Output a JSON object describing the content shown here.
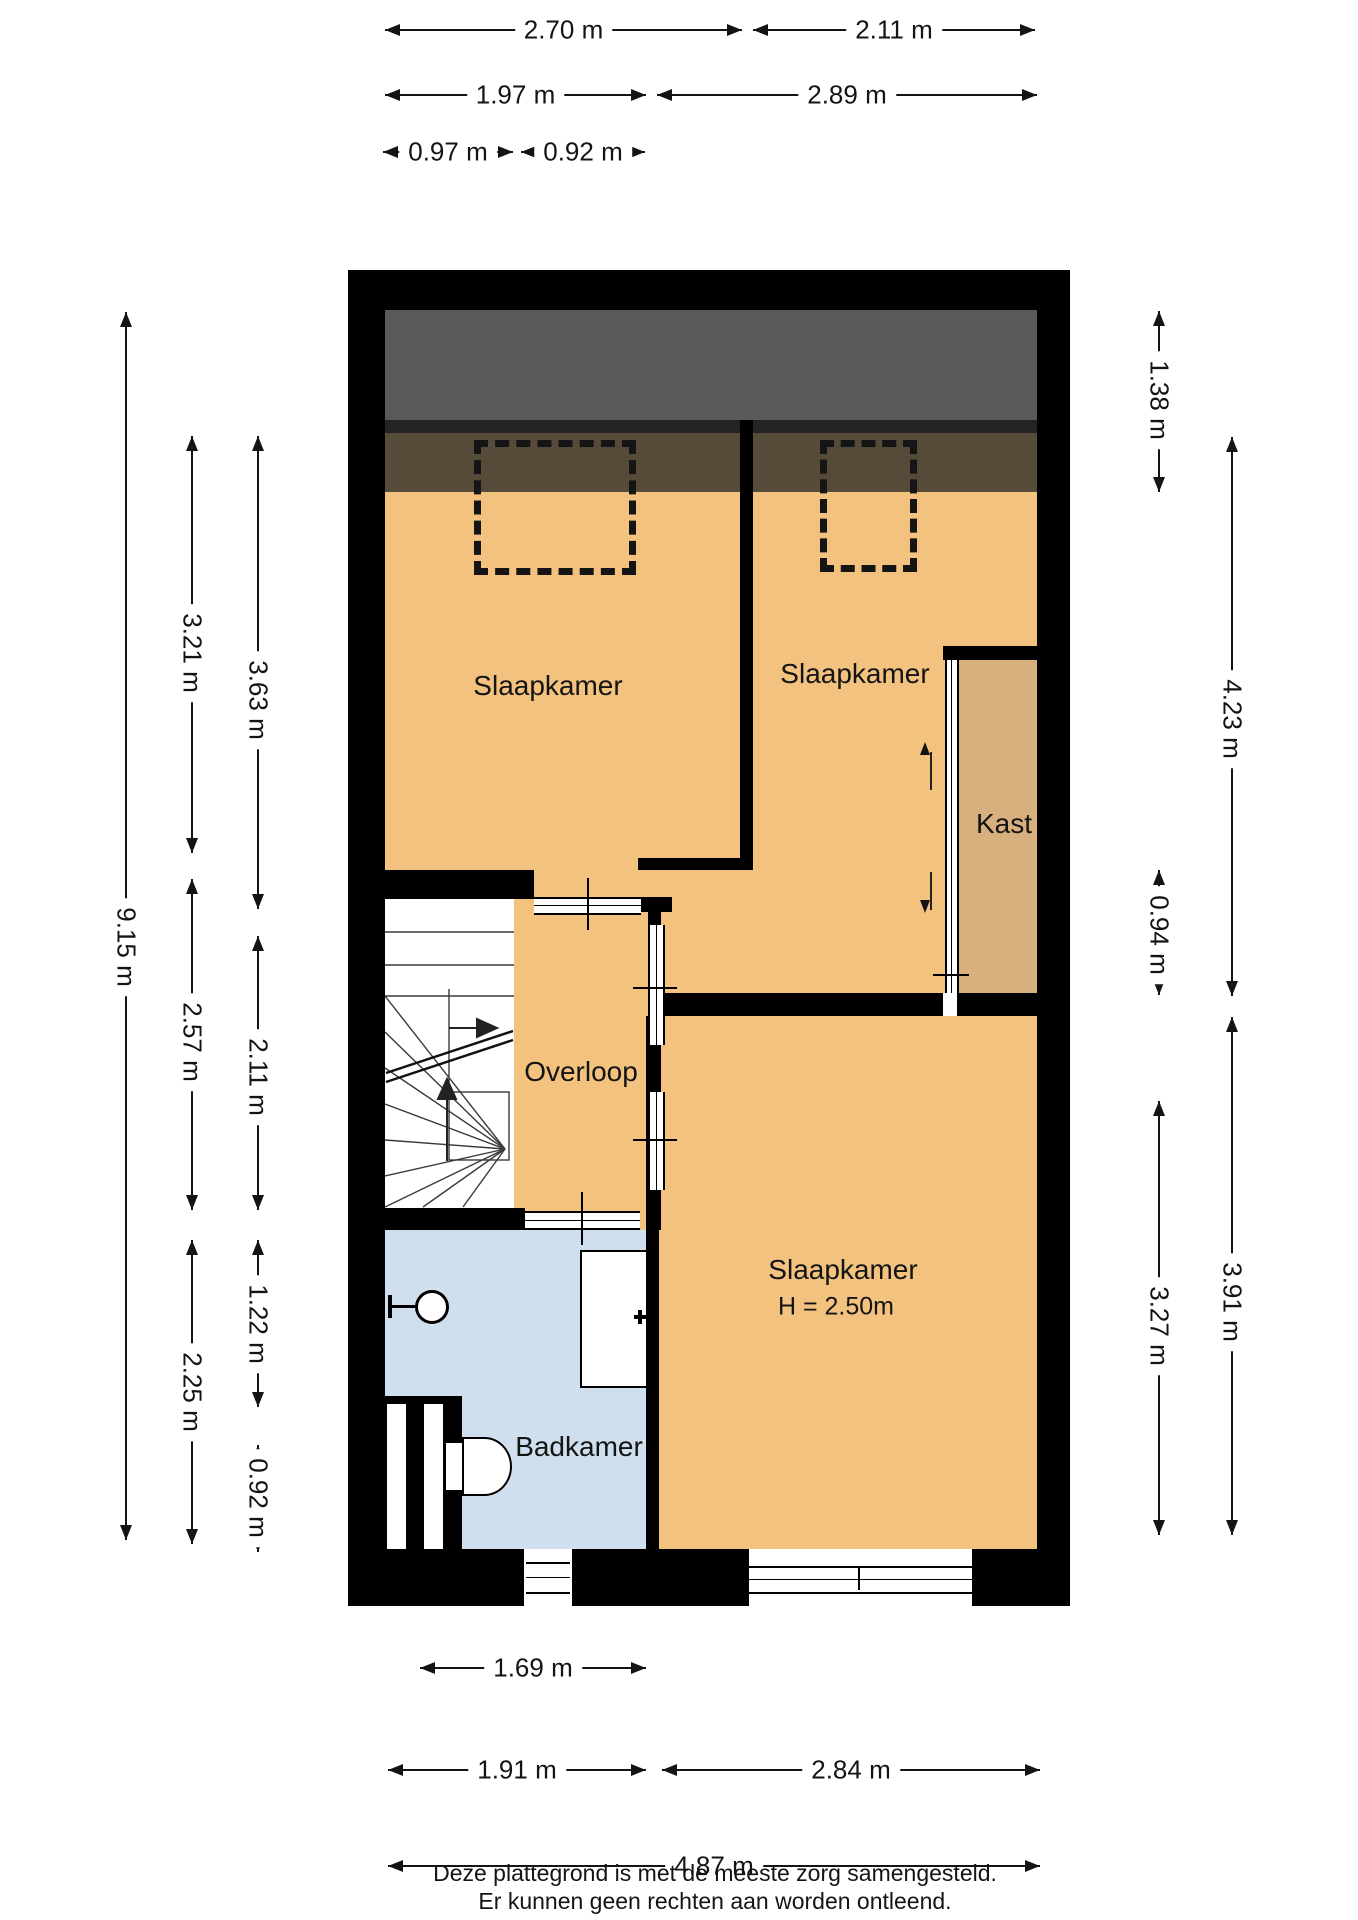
{
  "colors": {
    "wall": "#000000",
    "floor_orange": "#f2c27e",
    "closet_tan": "#d8b07e",
    "bathroom_blue": "#cfdfee",
    "roof_gray": "#595a5c",
    "roof_dark_strip": "#232323",
    "roof_brown": "#564a39",
    "dim_ink": "#141414"
  },
  "rooms": [
    {
      "id": "bedroom-1",
      "label": "Slaapkamer",
      "x": 548,
      "y": 686,
      "size": 28
    },
    {
      "id": "bedroom-2",
      "label": "Slaapkamer",
      "x": 855,
      "y": 674,
      "size": 28
    },
    {
      "id": "closet",
      "label": "Kast",
      "x": 1004,
      "y": 824,
      "size": 28
    },
    {
      "id": "landing",
      "label": "Overloop",
      "x": 581,
      "y": 1072,
      "size": 28
    },
    {
      "id": "bedroom-3",
      "label": "Slaapkamer",
      "x": 843,
      "y": 1270,
      "size": 28
    },
    {
      "id": "bedroom-3-height",
      "label": "H = 2.50m",
      "x": 836,
      "y": 1307,
      "size": 25
    },
    {
      "id": "bathroom",
      "label": "Badkamer",
      "x": 579,
      "y": 1447,
      "size": 28
    }
  ],
  "dimensions_horizontal": [
    {
      "label": "2.70 m",
      "x1": 385,
      "x2": 742,
      "y": 30
    },
    {
      "label": "2.11 m",
      "x1": 753,
      "x2": 1035,
      "y": 30
    },
    {
      "label": "1.97 m",
      "x1": 385,
      "x2": 646,
      "y": 95
    },
    {
      "label": "2.89 m",
      "x1": 657,
      "x2": 1037,
      "y": 95
    },
    {
      "label": "0.97 m",
      "x1": 383,
      "x2": 513,
      "y": 152
    },
    {
      "label": "0.92 m",
      "x1": 521,
      "x2": 645,
      "y": 152
    },
    {
      "label": "1.69 m",
      "x1": 420,
      "x2": 646,
      "y": 1668
    },
    {
      "label": "1.91 m",
      "x1": 388,
      "x2": 646,
      "y": 1770
    },
    {
      "label": "2.84 m",
      "x1": 662,
      "x2": 1040,
      "y": 1770
    },
    {
      "label": "4.87 m",
      "x1": 388,
      "x2": 1040,
      "y": 1866
    }
  ],
  "dimensions_vertical": [
    {
      "label": "9.15 m",
      "y1": 312,
      "y2": 1540,
      "x": 126,
      "ly": 947
    },
    {
      "label": "3.21 m",
      "y1": 436,
      "y2": 853,
      "x": 192,
      "ly": 653
    },
    {
      "label": "2.57 m",
      "y1": 879,
      "y2": 1210,
      "x": 192,
      "ly": 1042
    },
    {
      "label": "2.25 m",
      "y1": 1240,
      "y2": 1544,
      "x": 192,
      "ly": 1392
    },
    {
      "label": "3.63 m",
      "y1": 436,
      "y2": 909,
      "x": 258,
      "ly": 700
    },
    {
      "label": "2.11 m",
      "y1": 936,
      "y2": 1210,
      "x": 258,
      "ly": 1077
    },
    {
      "label": "1.22 m",
      "y1": 1240,
      "y2": 1407,
      "x": 258,
      "ly": 1324
    },
    {
      "label": "0.92 m",
      "y1": 1445,
      "y2": 1552,
      "x": 258,
      "ly": 1498
    },
    {
      "label": "1.38 m",
      "y1": 311,
      "y2": 492,
      "x": 1159,
      "ly": 400
    },
    {
      "label": "0.94 m",
      "y1": 870,
      "y2": 995,
      "x": 1159,
      "ly": 935
    },
    {
      "label": "3.27 m",
      "y1": 1101,
      "y2": 1535,
      "x": 1159,
      "ly": 1326
    },
    {
      "label": "4.23 m",
      "y1": 437,
      "y2": 996,
      "x": 1232,
      "ly": 719
    },
    {
      "label": "3.91 m",
      "y1": 1017,
      "y2": 1535,
      "x": 1232,
      "ly": 1302
    }
  ],
  "footer": {
    "line1": "Deze plattegrond is met de meeste zorg samengesteld.",
    "line2": "Er kunnen geen rechten aan worden ontleend."
  }
}
